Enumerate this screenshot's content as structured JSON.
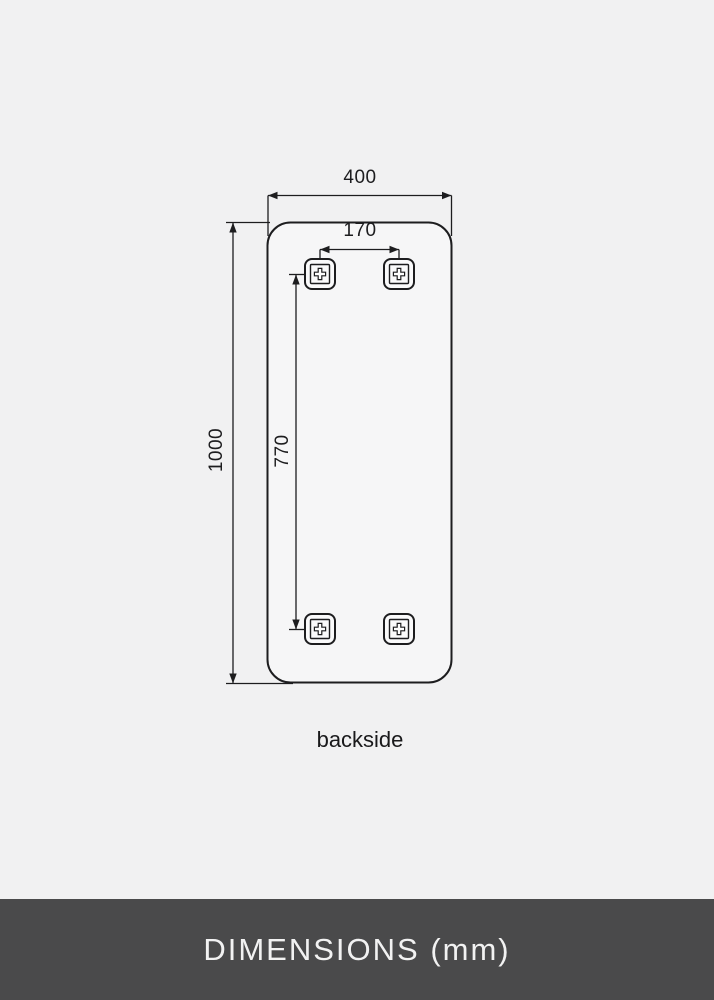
{
  "drawing": {
    "dimensions": {
      "overall_width_mm": "400",
      "overall_height_mm": "1000",
      "bracket_spacing_horizontal_mm": "170",
      "bracket_spacing_vertical_mm": "770"
    },
    "caption": "backside",
    "bracket_icon": "mounting-bracket-icon"
  },
  "footer": {
    "title": "DIMENSIONS (mm)"
  },
  "colors": {
    "page-bg": "#f1f1f2",
    "mirror-fill": "#f6f6f7",
    "line": "#1d1d1f",
    "footer-bg": "#4a4a4b",
    "footer-text": "#f2f2f2"
  }
}
